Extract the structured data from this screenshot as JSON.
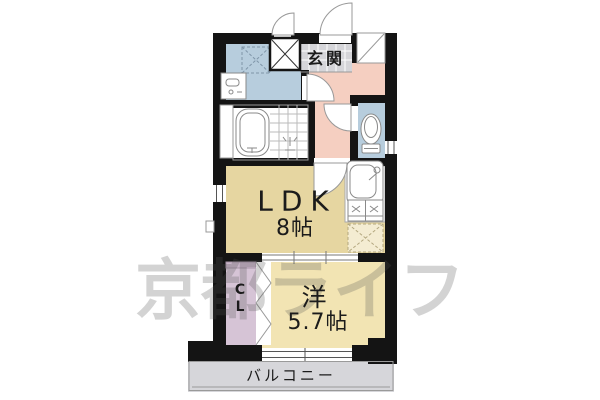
{
  "rooms": {
    "entrance": {
      "label": "玄関"
    },
    "ldk": {
      "label": "LDK",
      "size": "8帖"
    },
    "western_room": {
      "label": "洋",
      "size": "5.7帖"
    },
    "closet": {
      "char_top": "C",
      "char_bottom": "L"
    },
    "balcony": {
      "label": "バルコニー"
    }
  },
  "watermark": {
    "text": "京都ライフ"
  },
  "fixtures": [
    "bathtub",
    "shower",
    "washbasin",
    "washing-machine-space",
    "pipe-space",
    "shoe-cabinet",
    "toilet",
    "kitchen-sink",
    "gas-stove",
    "refrigerator-space",
    "entrance-door",
    "meter-box-door",
    "washroom-door",
    "toilet-door",
    "ldk-door",
    "sliding-door",
    "folding-door",
    "window"
  ],
  "colors": {
    "wall": "#141414",
    "water_rooms": "#b7cddd",
    "hallway": "#f5cfc1",
    "ldk": "#e6d6a1",
    "western_room": "#f2e4b3",
    "closet": "#d6c4d6",
    "closet_shelf": "#c9b5c9",
    "entrance_tile": "#d5d5d9",
    "balcony": "#d6d6da",
    "fridge_space": "#f4ecd2",
    "fixture_stroke": "#8a8a8a",
    "watermark": "rgba(80,80,80,0.25)"
  }
}
